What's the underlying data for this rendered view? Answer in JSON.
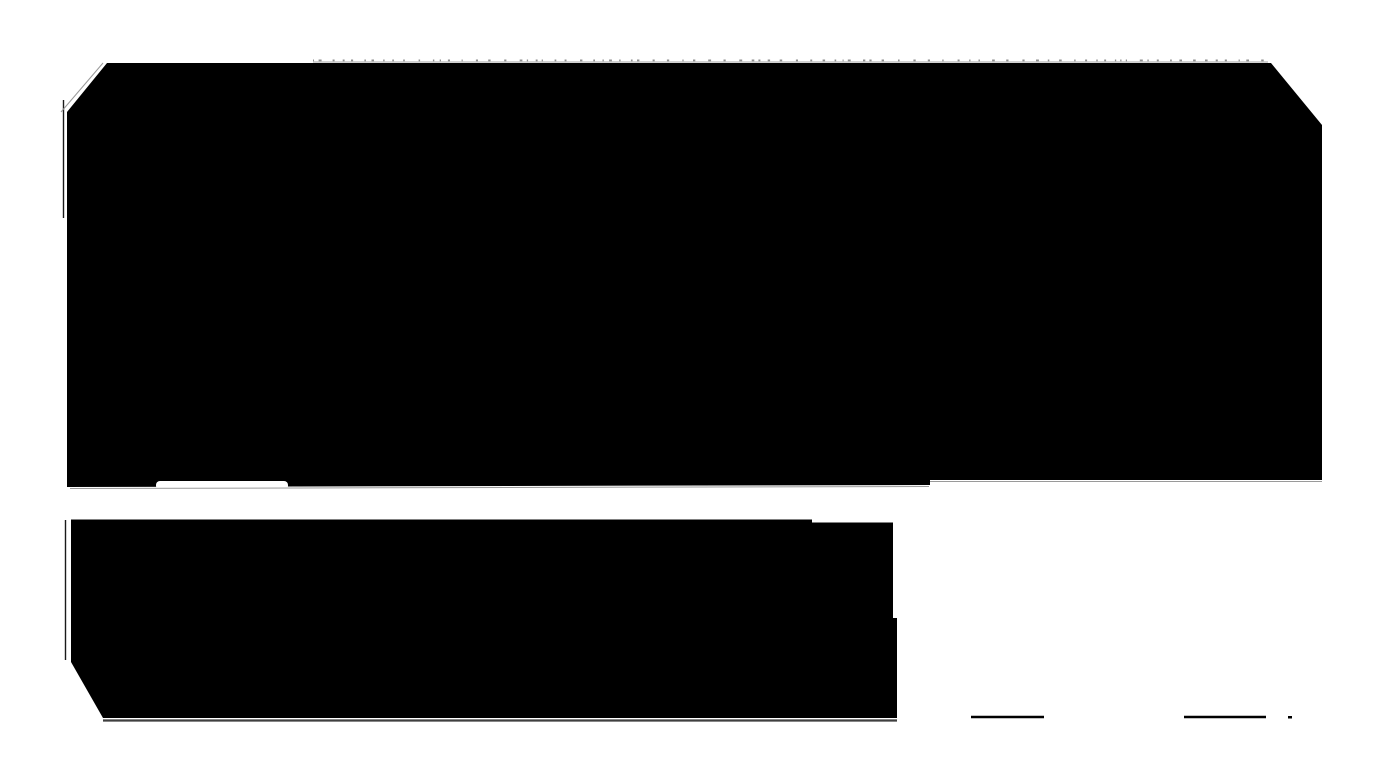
{
  "canvas": {
    "width": 1393,
    "height": 783,
    "background": "#ffffff"
  },
  "palette": {
    "block": "#000000",
    "page_background": "#ffffff",
    "shadow_dark": "#3f3f3f",
    "shadow_light": "#9a9a9a",
    "hairline": "#b8b8b8",
    "dash": "#8f8f8f"
  },
  "shapes": [
    {
      "name": "top-black-block",
      "type": "polygon",
      "fill": "#000000",
      "points": [
        [
          107,
          63
        ],
        [
          1271,
          63
        ],
        [
          1322,
          125
        ],
        [
          1322,
          480
        ],
        [
          930,
          480
        ],
        [
          930,
          485
        ],
        [
          67,
          487
        ],
        [
          67,
          112
        ]
      ]
    },
    {
      "name": "top-block-tab-notch",
      "type": "rect",
      "fill": "#ffffff",
      "x": 156,
      "y": 481,
      "width": 132,
      "height": 9,
      "rx": 4
    },
    {
      "name": "top-block-left-hairline",
      "type": "line",
      "stroke": "#1a1a1a",
      "width": 1.4,
      "x1": 63.5,
      "y1": 100,
      "x2": 63.5,
      "y2": 218
    },
    {
      "name": "top-block-corner-hairline",
      "type": "line",
      "stroke": "#999999",
      "width": 1,
      "x1": 61,
      "y1": 112,
      "x2": 103,
      "y2": 63
    },
    {
      "name": "top-edge-hairline",
      "type": "line",
      "stroke": "#b8b8b8",
      "width": 1.2,
      "x1": 313,
      "y1": 62,
      "x2": 1268,
      "y2": 62
    },
    {
      "name": "top-block-bottom-shadow-left",
      "type": "line",
      "stroke": "#9a9a9a",
      "width": 1,
      "x1": 70,
      "y1": 488.5,
      "x2": 929,
      "y2": 486.5
    },
    {
      "name": "top-block-bottom-shadow-right",
      "type": "line",
      "stroke": "#9a9a9a",
      "width": 1,
      "x1": 930,
      "y1": 481.5,
      "x2": 1322,
      "y2": 481.5
    },
    {
      "name": "bottom-black-block",
      "type": "polygon",
      "fill": "#000000",
      "points": [
        [
          71,
          519.5
        ],
        [
          812,
          519.5
        ],
        [
          812,
          522.5
        ],
        [
          814,
          522.5
        ],
        [
          893,
          522.5
        ],
        [
          893,
          618
        ],
        [
          897,
          618
        ],
        [
          897,
          718
        ],
        [
          103,
          718
        ],
        [
          71,
          662
        ]
      ]
    },
    {
      "name": "bottom-block-left-hairline",
      "type": "line",
      "stroke": "#1a1a1a",
      "width": 1.4,
      "x1": 65.5,
      "y1": 520,
      "x2": 65.5,
      "y2": 660
    },
    {
      "name": "bottom-block-shadow",
      "type": "line",
      "stroke": "#3f3f3f",
      "width": 2.2,
      "x1": 103,
      "y1": 720.5,
      "x2": 897,
      "y2": 720.5
    },
    {
      "name": "footer-rule-left",
      "type": "line",
      "stroke": "#000000",
      "width": 2.6,
      "x1": 971,
      "y1": 717,
      "x2": 1044,
      "y2": 717
    },
    {
      "name": "footer-rule-right",
      "type": "line",
      "stroke": "#000000",
      "width": 2.6,
      "x1": 1184,
      "y1": 717,
      "x2": 1266,
      "y2": 717
    },
    {
      "name": "footer-dot",
      "type": "rect",
      "fill": "#000000",
      "x": 1288,
      "y": 716,
      "width": 4,
      "height": 2.5,
      "rx": 0
    }
  ],
  "dash_row": {
    "y": 59.5,
    "x_start": 313,
    "x_end": 1266,
    "min_gap": 4,
    "max_gap": 14,
    "min_width": 1,
    "max_width": 3,
    "height": 1.8,
    "color": "#8f8f8f",
    "seed": 7
  }
}
